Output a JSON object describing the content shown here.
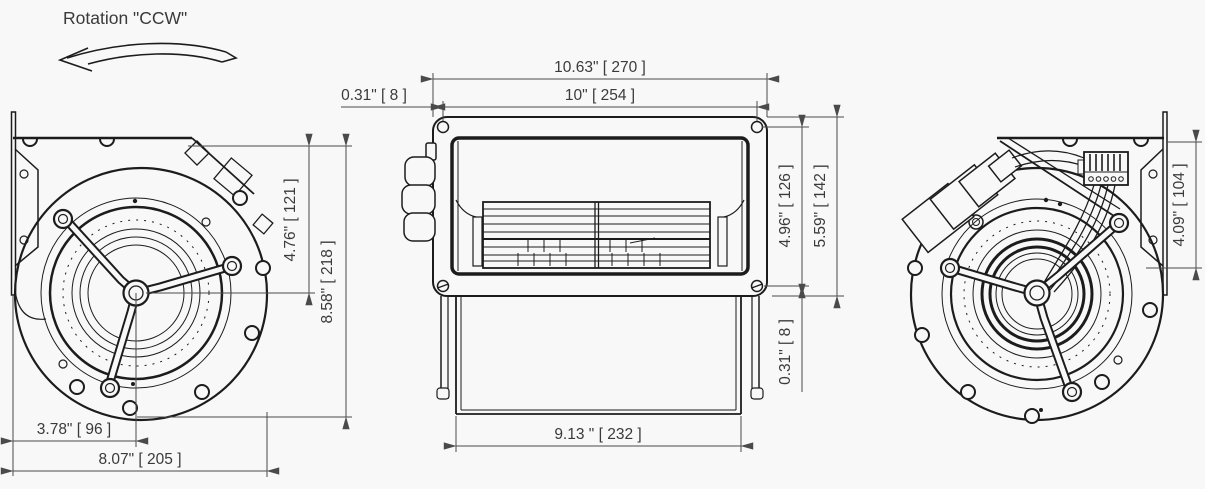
{
  "page": {
    "background": "#f8f8f8",
    "line_color": "#1c1c1c",
    "dim_line_color": "#4a4a4a",
    "text_color": "#3a3a3a"
  },
  "annotation": {
    "rotation_label": "Rotation \"CCW\""
  },
  "views": {
    "left": {
      "dims": {
        "center_height": "4.76\" [ 121 ]",
        "overall_height": "8.58\" [ 218 ]",
        "center_width": "3.78\" [ 96 ]",
        "overall_width": "8.07\" [ 205 ]"
      }
    },
    "front": {
      "dims": {
        "overall_width": "10.63\" [ 270 ]",
        "bolt_spacing_width": "10\" [ 254 ]",
        "edge_offset_top": "0.31\" [ 8 ]",
        "bolt_spacing_height": "4.96\" [ 126 ]",
        "overall_height": "5.59\" [ 142 ]",
        "edge_offset_bottom": "0.31\" [ 8 ]",
        "housing_width": "9.13 \" [ 232 ]"
      }
    },
    "right": {
      "dims": {
        "flange_hole_height": "4.09\" [ 104 ]"
      }
    }
  }
}
